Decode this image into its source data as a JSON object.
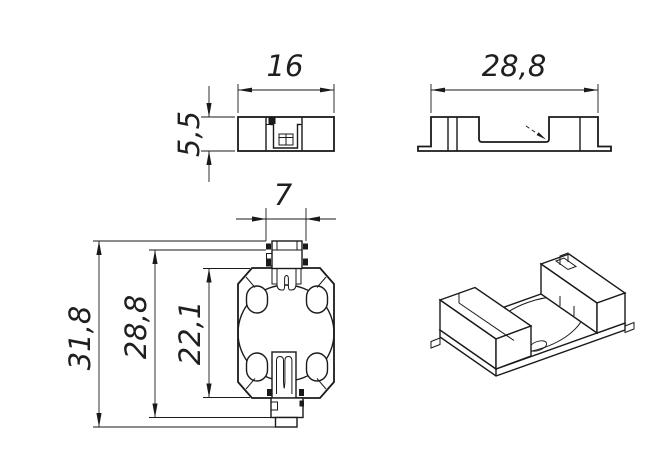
{
  "drawing": {
    "kind": "technical-drawing",
    "colors": {
      "line": "#1a1a1a",
      "background": "#ffffff"
    }
  },
  "dimensions": {
    "front_width": "16",
    "front_height": "5,5",
    "side_length": "28,8",
    "tab_width": "7",
    "overall_length": "31,8",
    "contact_span": "28,8",
    "body_length": "22,1"
  }
}
